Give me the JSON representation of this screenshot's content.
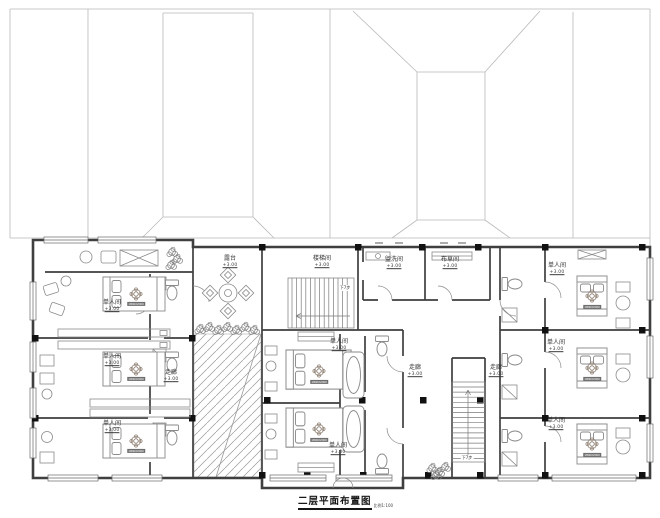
{
  "title": {
    "text": "二层平面布置图",
    "scale": "比例1:100"
  },
  "drawing_type": "hotel second-floor furniture layout plan with roof plan above",
  "rooms": [
    {
      "name": "single-room-left-1",
      "label": "单人间",
      "elevation": "+3.00"
    },
    {
      "name": "single-room-left-2",
      "label": "单人间",
      "elevation": "+3.00"
    },
    {
      "name": "single-room-left-3",
      "label": "单人间",
      "elevation": "+3.00"
    },
    {
      "name": "single-room-center-1",
      "label": "单人间",
      "elevation": "+3.00"
    },
    {
      "name": "single-room-center-2",
      "label": "单人间",
      "elevation": "+3.00"
    },
    {
      "name": "single-room-right-1",
      "label": "单人间",
      "elevation": "+3.00"
    },
    {
      "name": "single-room-right-2",
      "label": "单人间",
      "elevation": "+3.00"
    },
    {
      "name": "single-room-right-3",
      "label": "单人间",
      "elevation": "+3.00"
    },
    {
      "name": "terrace",
      "label": "露台",
      "elevation": "+3.00"
    },
    {
      "name": "stair-room",
      "label": "楼梯间",
      "elevation": "+3.00"
    },
    {
      "name": "washroom",
      "label": "盥洗间",
      "elevation": "+3.00"
    },
    {
      "name": "linen-room",
      "label": "布草间",
      "elevation": "+3.00"
    },
    {
      "name": "corridor-left",
      "label": "走廊",
      "elevation": "+3.00"
    },
    {
      "name": "corridor-center",
      "label": "走廊",
      "elevation": "+3.00"
    },
    {
      "name": "corridor-right",
      "label": "走廊",
      "elevation": "+3.00"
    }
  ],
  "stair_notes": [
    {
      "label": "下7步"
    },
    {
      "label": "下7步"
    }
  ],
  "bed_size_tag": "1800X2000",
  "colors": {
    "wall": "#3f3f3f",
    "column": "#111111",
    "furniture_line": "#8a8a8a",
    "roof_line": "#b9b9b9",
    "text": "#2e2e2e"
  }
}
